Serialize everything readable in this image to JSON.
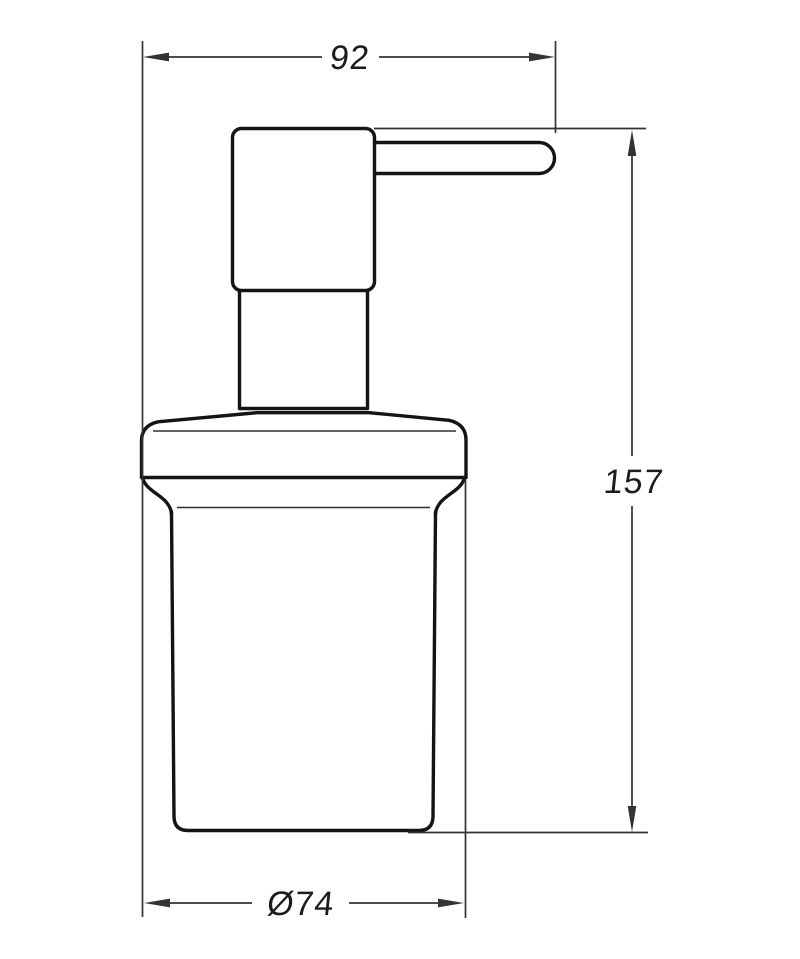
{
  "drawing": {
    "background": "#ffffff",
    "outline_color": "#141414",
    "detail_line_color": "#2e2e2e",
    "dimension_line_color": "#333333",
    "text_color": "#1c1c1c",
    "dimensions": {
      "width": {
        "label": "92",
        "value": 92,
        "orientation": "horizontal-top"
      },
      "height": {
        "label": "157",
        "value": 157,
        "orientation": "vertical-right"
      },
      "diameter": {
        "label": "Ø74",
        "value": 74,
        "orientation": "horizontal-bottom"
      }
    },
    "parts": [
      "pump-head",
      "spout",
      "pump-neck",
      "holder-collar",
      "bottle-body"
    ]
  }
}
